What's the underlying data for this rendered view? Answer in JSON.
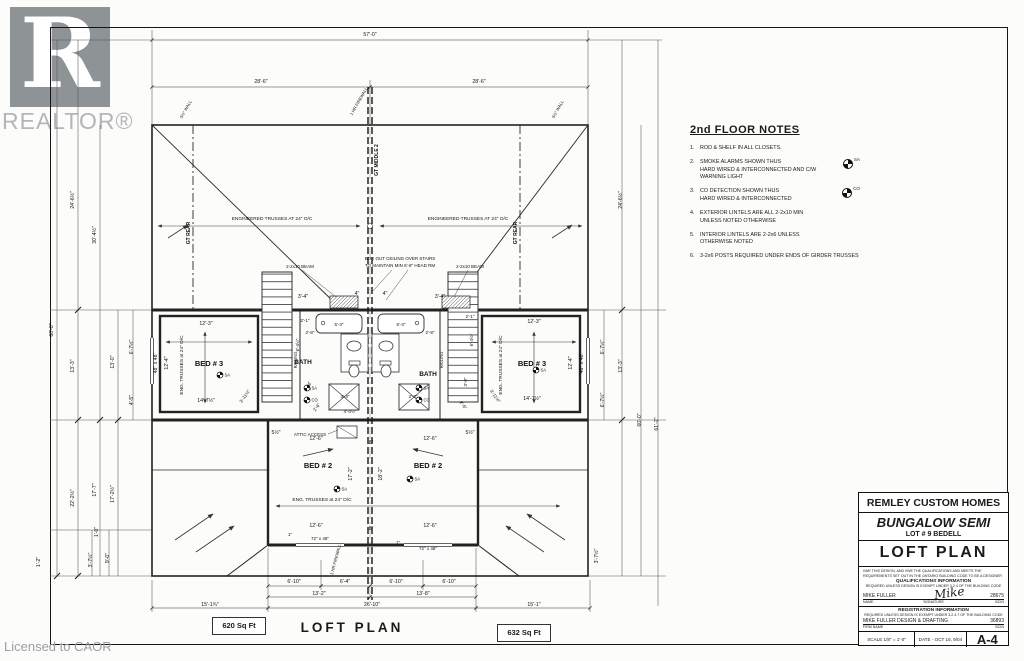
{
  "branding": {
    "logo_text": "REALTOR®",
    "logo_letter": "R",
    "license_text": "Licensed to CAOR"
  },
  "footer": {
    "left_area": "620 Sq Ft",
    "plan_title": "LOFT  PLAN",
    "right_area": "632 Sq Ft"
  },
  "notes": {
    "title": "2nd FLOOR NOTES",
    "items": [
      {
        "num": "1.",
        "text": "ROD & SHELF IN ALL CLOSETS."
      },
      {
        "num": "2.",
        "text": "SMOKE ALARMS SHOWN THUS\nHARD WIRED & INTERCONNECTED AND C/W\nWARNING LIGHT",
        "symbol": "SA"
      },
      {
        "num": "3.",
        "text": "CO DETECTION SHOWN THUS\nHARD WIRED & INTERCONNECTED",
        "symbol": "CO"
      },
      {
        "num": "4.",
        "text": "EXTERIOR LINTELS ARE ALL  2-2x10 MIN\nUNLESS NOTED OTHERWISE"
      },
      {
        "num": "5.",
        "text": "INTERIOR LINTELS ARE 2-2x6 UNLESS\nOTHERWISE NOTED"
      },
      {
        "num": "6.",
        "text": "3-2x6 POSTS REQUIRED UNDER ENDS OF GIRDER TRUSSES"
      }
    ]
  },
  "title_block": {
    "company": "REMLEY CUSTOM HOMES",
    "model": "BUNGALOW SEMI",
    "lot": "LOT #  9  BEDELL",
    "sheet_title": "LOFT  PLAN",
    "declaration": "I/WE THIS DESIGN, AND I/WE THE QUALIFICATIONS AND MEETS THE REQUIREMENTS SET OUT IN THE ONTARIO BUILDING CODE TO BE A DESIGNER",
    "qual_heading": "QUALIFICATIONS INFORMATION",
    "qual_note": "REQUIRED UNLESS DESIGN IS EXEMPT UNDER 3.2.4 OF THE BUILDING CODE",
    "designer_name": "MIKE FULLER",
    "signature_text": "Mike",
    "designer_bcin": "28675",
    "name_label": "NAME",
    "signature_label": "SIGNATURE",
    "bcin_label": "BCIN",
    "reg_heading": "REGISTRATION INFORMATION",
    "reg_note": "REQUIRED UNLESS DESIGN IS EXEMPT UNDER 3.2.4.7 OF THE BUILDING CODE",
    "firm_name": "MIKE FULLER DESIGN & DRAFTING",
    "firm_bcin": "36893",
    "firm_label": "FIRM NAME",
    "bcin_label2": "BCIN",
    "scale": "SCALE   1/8\" = 1'-0\"",
    "date": "DATE - OCT 16, 9/04",
    "sheet_no": "A-4"
  },
  "plan": {
    "texts": [
      {
        "t": "57'-0\"",
        "x": 370,
        "y": 36
      },
      {
        "t": "28'-6\"",
        "x": 261,
        "y": 83
      },
      {
        "t": "28'-6\"",
        "x": 479,
        "y": 83
      },
      {
        "t": "60'-0\"",
        "x": 53,
        "y": 330,
        "r": -90
      },
      {
        "t": "24'-6½\"",
        "x": 74,
        "y": 200,
        "r": -90
      },
      {
        "t": "13'-3\"",
        "x": 74,
        "y": 366,
        "r": -90
      },
      {
        "t": "22'-2½\"",
        "x": 74,
        "y": 498,
        "r": -90
      },
      {
        "t": "30'-4½\"",
        "x": 96,
        "y": 235,
        "r": -90
      },
      {
        "t": "13'-0\"",
        "x": 114,
        "y": 362,
        "r": -90
      },
      {
        "t": "17'-7\"",
        "x": 96,
        "y": 490,
        "r": -90
      },
      {
        "t": "17'-2½\"",
        "x": 114,
        "y": 494,
        "r": -90
      },
      {
        "t": "6'-7½\"",
        "x": 133,
        "y": 347,
        "r": -90
      },
      {
        "t": "4'-5\"",
        "x": 133,
        "y": 400,
        "r": -90
      },
      {
        "t": "12'-4\"",
        "x": 168,
        "y": 363,
        "r": -90
      },
      {
        "t": "48\" x 48\"",
        "x": 157,
        "y": 363,
        "r": -90
      },
      {
        "t": "1'-0\"",
        "x": 98,
        "y": 532,
        "r": -90
      },
      {
        "t": "3'-7½\"",
        "x": 92,
        "y": 560,
        "r": -90
      },
      {
        "t": "9'-0\"",
        "x": 109,
        "y": 558,
        "r": -90
      },
      {
        "t": "1'-2\"",
        "x": 40,
        "y": 562,
        "r": -90
      },
      {
        "t": "24'-6½\"",
        "x": 622,
        "y": 200,
        "r": -90
      },
      {
        "t": "6'-7½\"",
        "x": 604,
        "y": 347,
        "r": -90
      },
      {
        "t": "13'-3\"",
        "x": 622,
        "y": 366,
        "r": -90
      },
      {
        "t": "6'-7½\"",
        "x": 604,
        "y": 400,
        "r": -90
      },
      {
        "t": "60'-0\"",
        "x": 641,
        "y": 420,
        "r": -90
      },
      {
        "t": "61'-2\"",
        "x": 658,
        "y": 424,
        "r": -90
      },
      {
        "t": "12'-4\"",
        "x": 572,
        "y": 363,
        "r": -90
      },
      {
        "t": "48\" x 48\"",
        "x": 583,
        "y": 363,
        "r": -90
      },
      {
        "t": "3'-7½\"",
        "x": 598,
        "y": 556,
        "r": -90
      },
      {
        "t": "6'-10\"",
        "x": 294,
        "y": 583
      },
      {
        "t": "6'-4\"",
        "x": 345,
        "y": 583
      },
      {
        "t": "6'-10\"",
        "x": 396,
        "y": 583
      },
      {
        "t": "6'-10\"",
        "x": 449,
        "y": 583
      },
      {
        "t": "13'-2\"",
        "x": 319,
        "y": 595
      },
      {
        "t": "13'-8\"",
        "x": 423,
        "y": 595
      },
      {
        "t": "26'-10\"",
        "x": 372,
        "y": 606
      },
      {
        "t": "15'-1¾\"",
        "x": 210,
        "y": 606
      },
      {
        "t": "15'-1\"",
        "x": 534,
        "y": 606
      },
      {
        "t": "BED # 3",
        "x": 209,
        "y": 366,
        "fs": 7.5,
        "w": 1,
        "n": "room-label-bed3-left"
      },
      {
        "t": "BED # 3",
        "x": 532,
        "y": 366,
        "fs": 7.5,
        "w": 1,
        "n": "room-label-bed3-right"
      },
      {
        "t": "BED # 2",
        "x": 318,
        "y": 468,
        "fs": 7.5,
        "w": 1,
        "n": "room-label-bed2-left"
      },
      {
        "t": "BED # 2",
        "x": 428,
        "y": 468,
        "fs": 7.5,
        "w": 1,
        "n": "room-label-bed2-right"
      },
      {
        "t": "BATH",
        "x": 303,
        "y": 364,
        "fs": 6.5,
        "w": 1,
        "n": "room-label-bath-left"
      },
      {
        "t": "BATH",
        "x": 428,
        "y": 376,
        "fs": 6.5,
        "w": 1,
        "n": "room-label-bath-right"
      },
      {
        "t": "12'-3\"",
        "x": 206,
        "y": 325
      },
      {
        "t": "12'-3\"",
        "x": 534,
        "y": 323
      },
      {
        "t": "14'-7½\"",
        "x": 206,
        "y": 402
      },
      {
        "t": "14'-7½\"",
        "x": 532,
        "y": 400
      },
      {
        "t": "12'-6\"",
        "x": 316,
        "y": 440
      },
      {
        "t": "12'-6\"",
        "x": 430,
        "y": 440
      },
      {
        "t": "12'-6\"",
        "x": 316,
        "y": 527
      },
      {
        "t": "12'-6\"",
        "x": 430,
        "y": 527
      },
      {
        "t": "8\"",
        "x": 371,
        "y": 444
      },
      {
        "t": "8\"",
        "x": 371,
        "y": 530
      },
      {
        "t": "5½\"",
        "x": 276,
        "y": 434
      },
      {
        "t": "5½\"",
        "x": 470,
        "y": 434
      },
      {
        "t": "17'-2\"",
        "x": 352,
        "y": 474,
        "r": -90
      },
      {
        "t": "18'-2\"",
        "x": 382,
        "y": 474,
        "r": -90
      },
      {
        "t": "72\" x 48\"",
        "x": 320,
        "y": 540,
        "fs": 4.5
      },
      {
        "t": "72\" x 48\"",
        "x": 428,
        "y": 550,
        "fs": 4.5
      },
      {
        "t": "5'-3\"",
        "x": 339,
        "y": 326,
        "fs": 4.5
      },
      {
        "t": "5'-3\"",
        "x": 401,
        "y": 326,
        "fs": 4.5
      },
      {
        "t": "3'-4\"",
        "x": 303,
        "y": 298
      },
      {
        "t": "3'-4\"",
        "x": 440,
        "y": 298
      },
      {
        "t": "4\"",
        "x": 357,
        "y": 295
      },
      {
        "t": "4\"",
        "x": 385,
        "y": 295
      },
      {
        "t": "2'-8\"",
        "x": 310,
        "y": 334,
        "fs": 4.5
      },
      {
        "t": "2'-8\"",
        "x": 430,
        "y": 334,
        "fs": 4.5
      },
      {
        "t": "3'-3\"",
        "x": 345,
        "y": 398,
        "fs": 4.5
      },
      {
        "t": "3'-3\"",
        "x": 413,
        "y": 398,
        "fs": 4.5
      },
      {
        "t": "4'-0½\"",
        "x": 350,
        "y": 413,
        "fs": 4.5
      },
      {
        "t": "6'-4½\"",
        "x": 299,
        "y": 345,
        "r": -90,
        "fs": 4.5
      },
      {
        "t": "6'-4½\"",
        "x": 473,
        "y": 340,
        "r": -90,
        "fs": 4.5
      },
      {
        "t": "3'-8\"",
        "x": 311,
        "y": 386,
        "r": -90,
        "fs": 4.5
      },
      {
        "t": "3'-8\"",
        "x": 467,
        "y": 382,
        "r": -90,
        "fs": 4.5
      },
      {
        "t": "2'-1\"",
        "x": 305,
        "y": 322,
        "fs": 4.5
      },
      {
        "t": "2'-1\"",
        "x": 470,
        "y": 318,
        "fs": 4.5
      },
      {
        "t": "2'-6\"",
        "x": 318,
        "y": 408,
        "r": -55,
        "fs": 4.5
      },
      {
        "t": "2'-6\"",
        "x": 462,
        "y": 406,
        "r": 55,
        "fs": 4.5
      },
      {
        "t": "3'-11½\"",
        "x": 246,
        "y": 397,
        "r": -55,
        "fs": 4.5
      },
      {
        "t": "3'-11½\"",
        "x": 494,
        "y": 397,
        "r": 55,
        "fs": 4.5
      },
      {
        "t": "1\"",
        "x": 290,
        "y": 536,
        "fs": 4.5
      },
      {
        "t": "1\"",
        "x": 398,
        "y": 544,
        "fs": 4.5
      },
      {
        "t": "ENGINEERED TRUSSES AT 24\" O/C",
        "x": 272,
        "y": 220,
        "fs": 4.8,
        "n": "truss-note"
      },
      {
        "t": "ENGINEERED TRUSSES AT 24\" O/C",
        "x": 468,
        "y": 220,
        "fs": 4.8,
        "n": "truss-note"
      },
      {
        "t": "ENG. TRUSSES at 24\" O/C",
        "x": 322,
        "y": 501,
        "fs": 4.8,
        "n": "truss-note"
      },
      {
        "t": "ENG. TRUSSES at 24\" O/C",
        "x": 183,
        "y": 365,
        "r": -90,
        "fs": 4.8,
        "n": "truss-note"
      },
      {
        "t": "ENG. TRUSSES at 24\" O/C",
        "x": 502,
        "y": 365,
        "r": -90,
        "fs": 4.8,
        "n": "truss-note"
      },
      {
        "t": "GT REAR",
        "x": 190,
        "y": 233,
        "r": -90,
        "fs": 5,
        "w": 1,
        "n": "girder-label"
      },
      {
        "t": "GT REAR",
        "x": 517,
        "y": 233,
        "r": -90,
        "fs": 5,
        "w": 1,
        "n": "girder-label"
      },
      {
        "t": "GT MIDDLE 2",
        "x": 378,
        "y": 160,
        "r": -90,
        "fs": 5,
        "w": 1,
        "n": "girder-label"
      },
      {
        "t": "RAILING",
        "x": 297,
        "y": 360,
        "r": -90,
        "fs": 4.2
      },
      {
        "t": "RAILING",
        "x": 443,
        "y": 360,
        "r": -90,
        "fs": 4.2
      },
      {
        "t": "2-2x10 BEAM",
        "x": 300,
        "y": 268,
        "fs": 4.5,
        "n": "beam-label"
      },
      {
        "t": "2-2x10 BEAM",
        "x": 470,
        "y": 268,
        "fs": 4.5,
        "n": "beam-label"
      },
      {
        "t": "BOX OUT CEILING OVER STAIRS",
        "x": 400,
        "y": 260,
        "fs": 4.5,
        "n": "boxout-note"
      },
      {
        "t": "TO MAINTAIN MIN 6'-8\" HEAD RM",
        "x": 400,
        "y": 267,
        "fs": 4.5,
        "n": "boxout-note"
      },
      {
        "t": "ATTIC ACCESS",
        "x": 310,
        "y": 436,
        "fs": 4.5
      },
      {
        "t": "1 HR FIREWALL",
        "x": 360,
        "y": 102,
        "r": -60,
        "fs": 4.2
      },
      {
        "t": "5½\" WALL",
        "x": 187,
        "y": 110,
        "r": -60,
        "fs": 4.2
      },
      {
        "t": "5½\" WALL",
        "x": 559,
        "y": 110,
        "r": -60,
        "fs": 4.2
      },
      {
        "t": "1 HR FIREWALL",
        "x": 337,
        "y": 560,
        "r": -75,
        "fs": 4.2
      }
    ],
    "detectors": [
      {
        "x": 220,
        "y": 375,
        "l": "SA"
      },
      {
        "x": 536,
        "y": 370,
        "l": "SA"
      },
      {
        "x": 337,
        "y": 489,
        "l": "SA"
      },
      {
        "x": 410,
        "y": 479,
        "l": "SA"
      },
      {
        "x": 307,
        "y": 388,
        "l": "SA"
      },
      {
        "x": 307,
        "y": 400,
        "l": "CO"
      },
      {
        "x": 419,
        "y": 388,
        "l": "SA"
      },
      {
        "x": 419,
        "y": 400,
        "l": "CO"
      }
    ]
  }
}
